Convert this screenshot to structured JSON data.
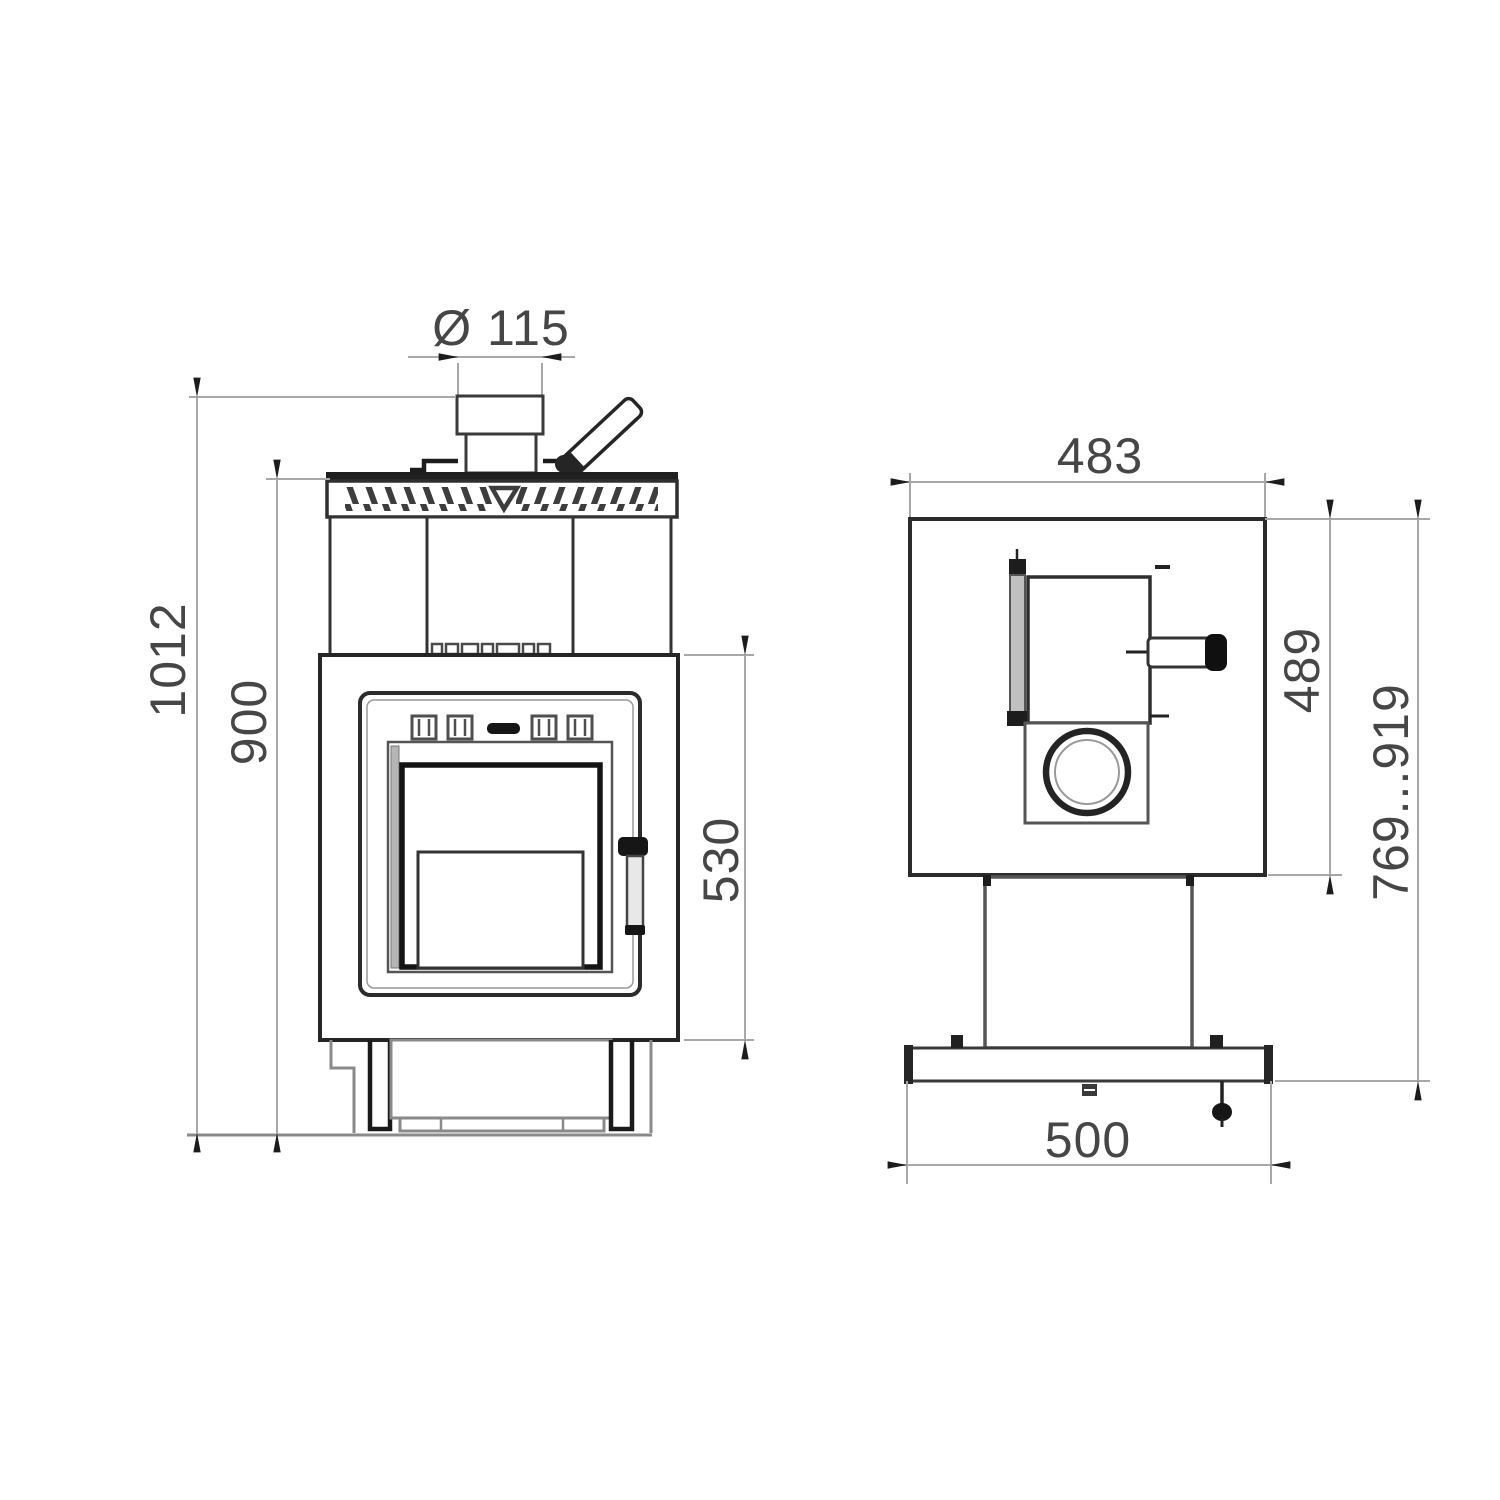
{
  "drawing": {
    "front_view": {
      "flue_diameter": "Ø 115",
      "overall_height": "1012",
      "body_height": "900",
      "door_section_height": "530"
    },
    "side_view": {
      "top_width": "483",
      "body_height": "489",
      "height_range": "769...919",
      "base_width": "500"
    },
    "colors": {
      "background": "#ffffff",
      "outline_dark": "#262626",
      "outline_medium": "#555555",
      "dimension_line": "#a8a8a8",
      "arrow": "#1c1c1c",
      "dimension_text": "#464646"
    }
  }
}
